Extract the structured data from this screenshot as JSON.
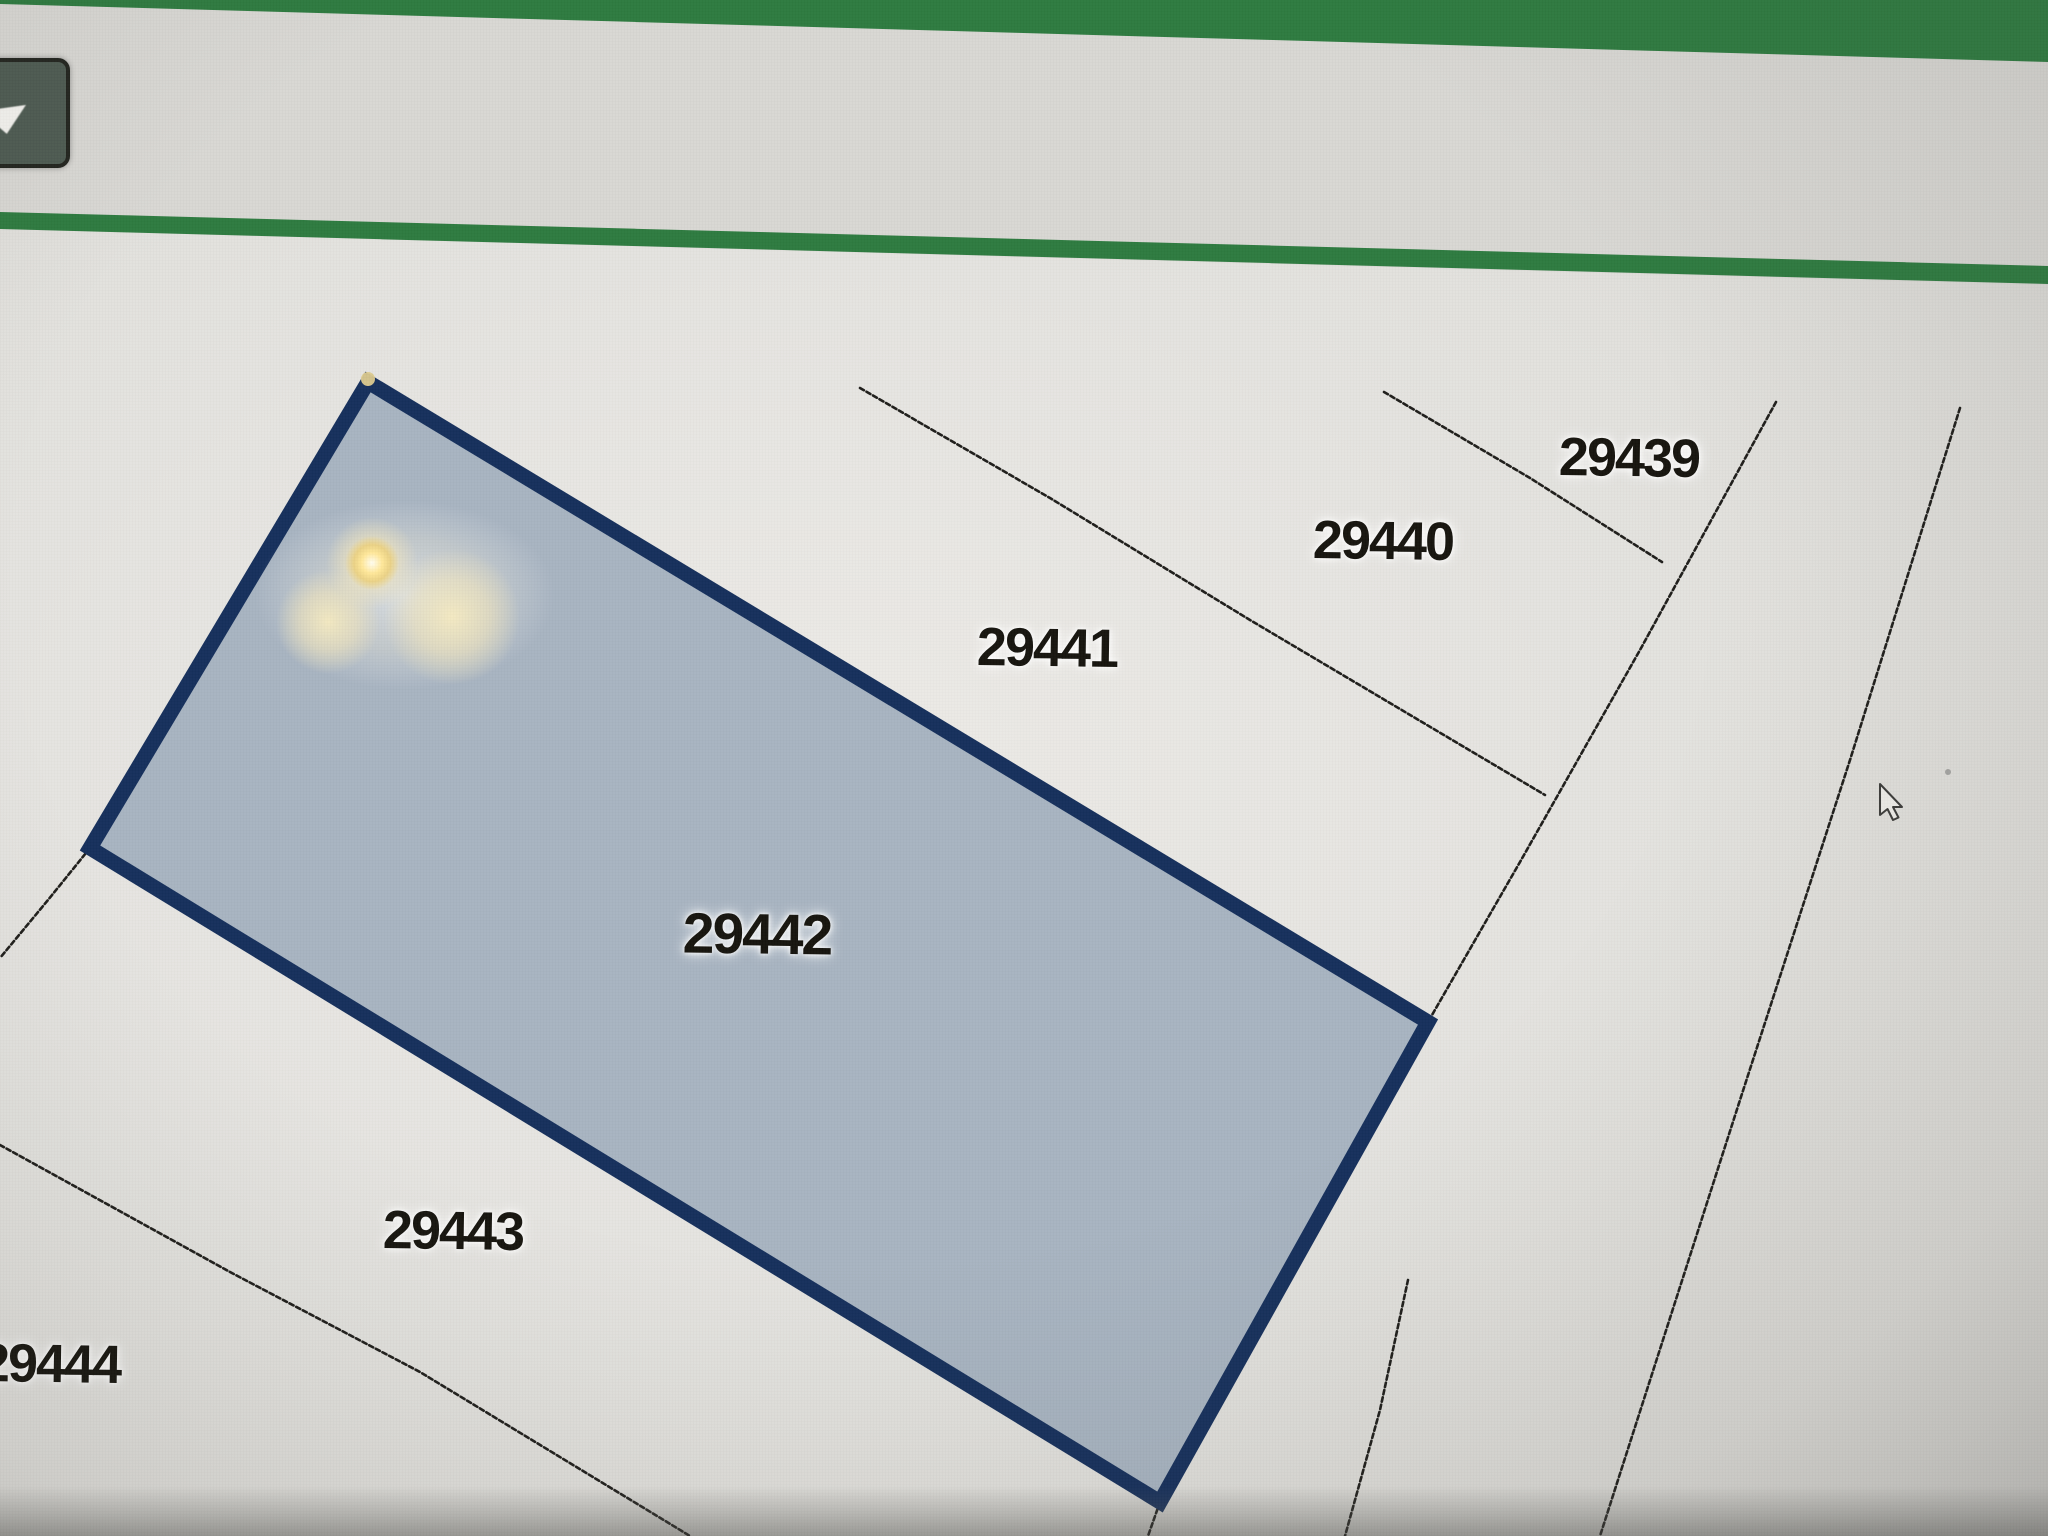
{
  "colors": {
    "accent_green": "#2e7b40",
    "toolbar_bg": "#d8d7d3",
    "map_bg": "#e2e1dd",
    "selected_parcel_fill": "#a8b4c1",
    "selected_parcel_border": "#16305c",
    "parcel_line": "#1f1e1b",
    "label_text": "#17150f",
    "dropdown_button_fill": "#4e5b52"
  },
  "toolbar": {
    "dropdown": {
      "icon": "chevron-down-icon"
    }
  },
  "map": {
    "parcels": [
      {
        "id": "29439",
        "selected": false
      },
      {
        "id": "29440",
        "selected": false
      },
      {
        "id": "29441",
        "selected": false
      },
      {
        "id": "29442",
        "selected": true
      },
      {
        "id": "29443",
        "selected": false
      },
      {
        "id": "29444",
        "selected": false
      }
    ],
    "selected_parcel_id": "29442"
  },
  "cursor": {
    "type": "arrow-pointer"
  }
}
